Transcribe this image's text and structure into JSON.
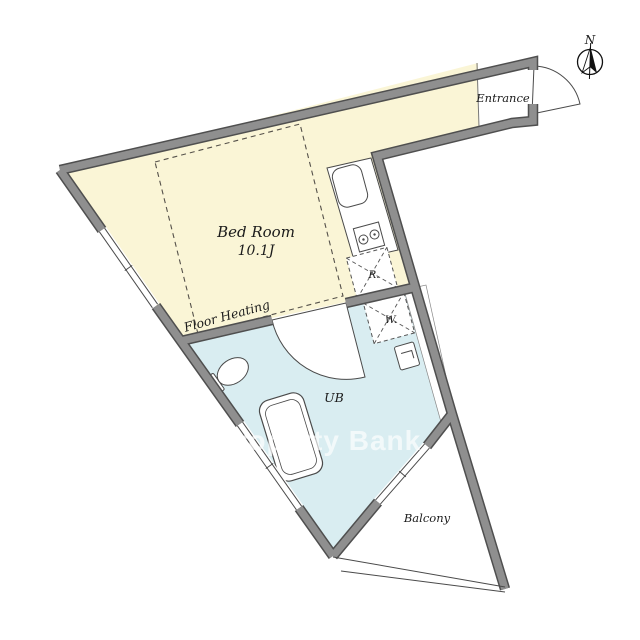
{
  "rooms": {
    "bedroom": {
      "name": "Bed Room",
      "size": "10.1J",
      "floor_note": "Floor Heating"
    },
    "entrance": {
      "label": "Entrance"
    },
    "bath": {
      "label": "UB"
    },
    "balcony": {
      "label": "Balcony"
    }
  },
  "appliances": {
    "refrigerator": "R.",
    "washer": "W."
  },
  "compass": {
    "north": "N"
  },
  "watermark": "Property Bank",
  "colors": {
    "bedroom_fill": "#faf5d6",
    "bath_fill": "#d9edf1",
    "wall": "#8f8f8f",
    "wall_edge": "#4f4f4f",
    "fixture_line": "#4a4a4a",
    "text": "#1b1b1b",
    "watermark": "#ffffff"
  }
}
